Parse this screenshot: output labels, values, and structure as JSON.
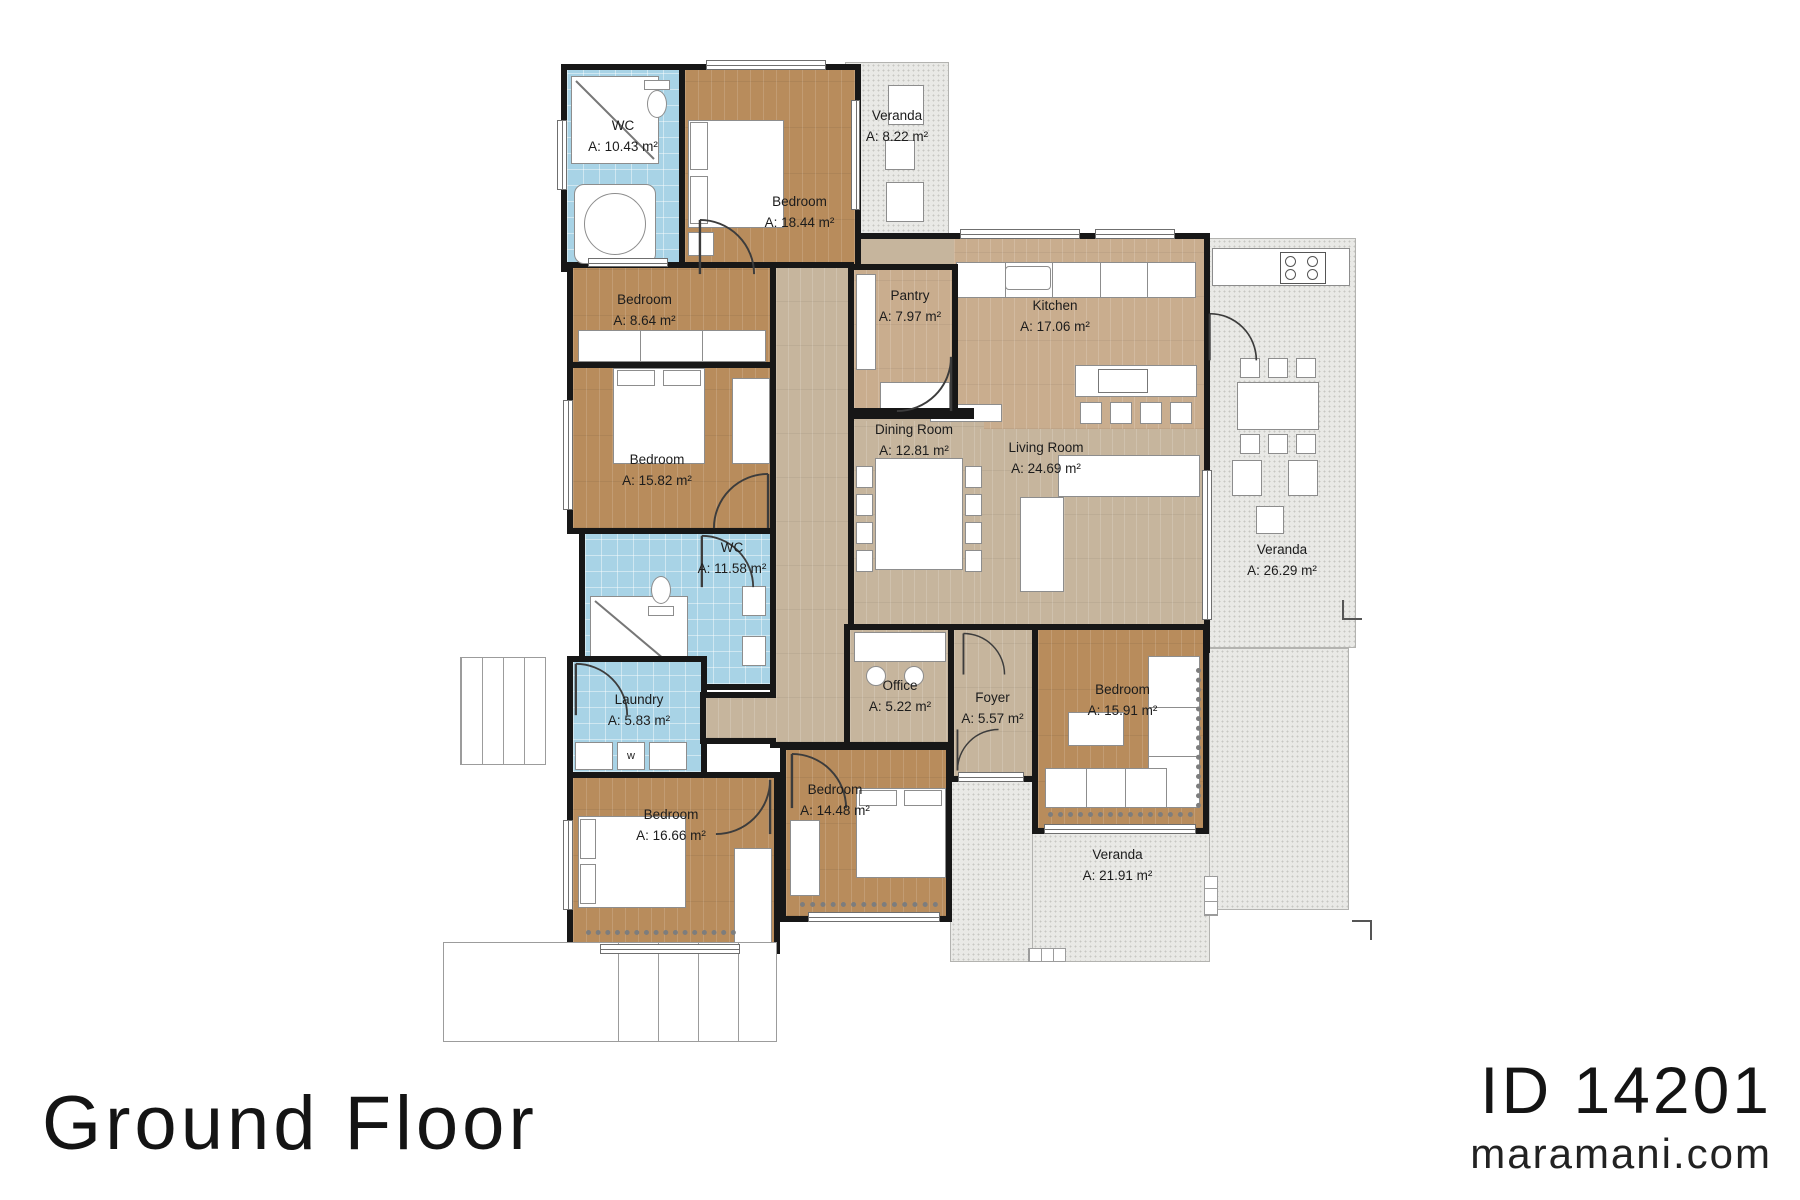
{
  "title": {
    "floor_label": "Ground Floor"
  },
  "brand": {
    "plan_id": "ID 14201",
    "site": "maramani.com"
  },
  "appliances": {
    "washer": "w"
  },
  "colors": {
    "wall": "#171717",
    "bedroom_floor": "#b88c5c",
    "common_floor": "#c6b59d",
    "kitchen_floor": "#c9ad8e",
    "wet_room": "#a8d3e6",
    "veranda": "#e9e9e6",
    "background": "#ffffff"
  },
  "rooms": [
    {
      "name": "WC",
      "area": "A: 10.43 m²"
    },
    {
      "name": "Bedroom",
      "area": "A: 18.44 m²"
    },
    {
      "name": "Veranda",
      "area": "A: 8.22 m²"
    },
    {
      "name": "Bedroom",
      "area": "A: 8.64 m²"
    },
    {
      "name": "Pantry",
      "area": "A: 7.97 m²"
    },
    {
      "name": "Kitchen",
      "area": "A: 17.06 m²"
    },
    {
      "name": "Bedroom",
      "area": "A: 15.82 m²"
    },
    {
      "name": "Dining Room",
      "area": "A:  12.81 m²"
    },
    {
      "name": "Living Room",
      "area": "A:  24.69 m²"
    },
    {
      "name": "Veranda",
      "area": "A: 26.29 m²"
    },
    {
      "name": "WC",
      "area": "A: 11.58 m²"
    },
    {
      "name": "Laundry",
      "area": "A: 5.83 m²"
    },
    {
      "name": "Office",
      "area": "A: 5.22 m²"
    },
    {
      "name": "Foyer",
      "area": "A: 5.57 m²"
    },
    {
      "name": "Bedroom",
      "area": "A: 15.91 m²"
    },
    {
      "name": "Bedroom",
      "area": "A: 16.66 m²"
    },
    {
      "name": "Bedroom",
      "area": "A: 14.48 m²"
    },
    {
      "name": "Veranda",
      "area": "A: 21.91 m²"
    }
  ]
}
